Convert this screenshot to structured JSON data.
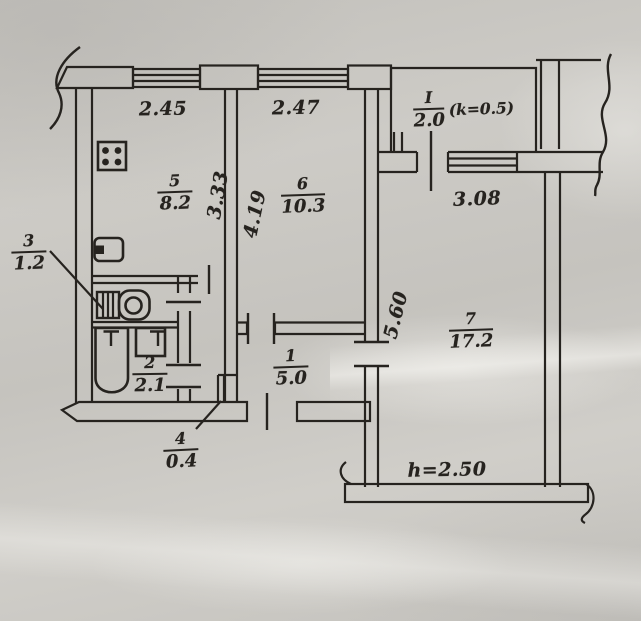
{
  "colors": {
    "paper": "#c7c5c0",
    "ink": "#26231f"
  },
  "rooms": {
    "r5": {
      "num": "5",
      "area": "8.2"
    },
    "r6": {
      "num": "6",
      "area": "10.3"
    },
    "r7": {
      "num": "7",
      "area": "17.2"
    },
    "r1": {
      "num": "1",
      "area": "5.0"
    },
    "r2": {
      "num": "2",
      "area": "2.1"
    },
    "r3": {
      "num": "3",
      "area": "1.2"
    },
    "r4": {
      "num": "4",
      "area": "0.4"
    },
    "balcony": {
      "num": "I",
      "area": "2.0",
      "coef": "(k=0.5)"
    }
  },
  "dims": {
    "d245": "2.45",
    "d247": "2.47",
    "d333": "3.33",
    "d419": "4.19",
    "d308": "3.08",
    "d560": "5.60",
    "height": "h=2.50"
  },
  "fixtures": [
    "stove-icon",
    "kitchen-sink-icon",
    "toilet-icon",
    "bathtub-icon",
    "washbasin-icon"
  ]
}
